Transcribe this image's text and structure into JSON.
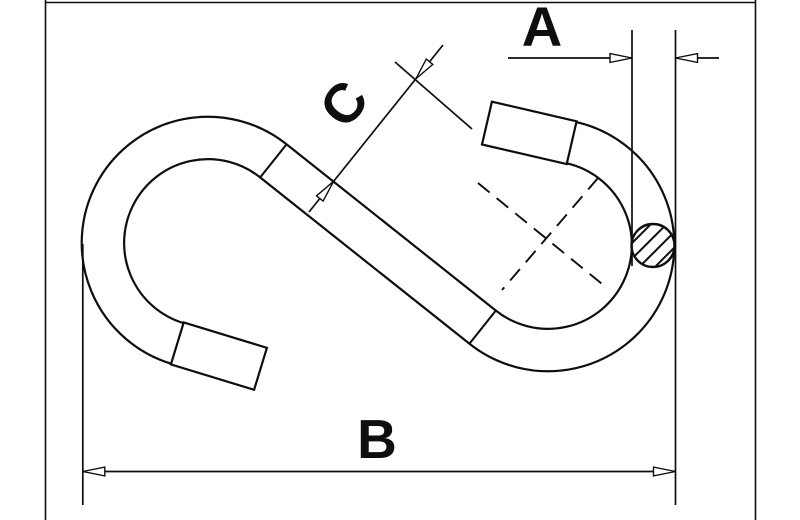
{
  "drawing": {
    "title": "S-hook dimensional line drawing",
    "labels": {
      "a": "A",
      "b": "B",
      "c": "C"
    },
    "features": {
      "section": "hatched-wire-cross-section",
      "centerlines": "dashed",
      "frame": "partial-border-frame"
    },
    "colors": {
      "line": "#0e0e0e",
      "background": "#ffffff"
    }
  }
}
